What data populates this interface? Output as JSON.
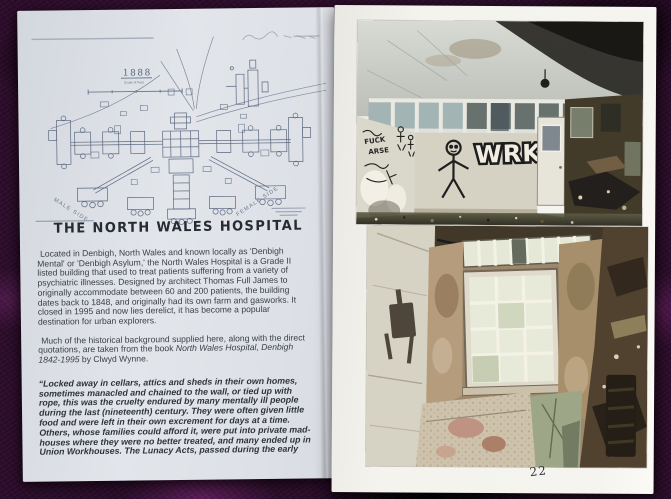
{
  "left_page": {
    "plan": {
      "year_label": "1888",
      "scale_label": "Scale of Feet",
      "male_side_label": "MALE SIDE",
      "female_side_label": "FEMALE SIDE"
    },
    "title": "THE NORTH WALES HOSPITAL",
    "intro_paragraph": "Located in Denbigh, North Wales and known locally as 'Denbigh Mental' or 'Denbigh Asylum,' the North Wales Hospital is a Grade II listed building that used to treat patients suffering from a variety of psychiatric illnesses. Designed by architect Thomas Full James to originally accommodate between 60 and 200 patients, the building dates back to 1848, and originally had its own farm and gasworks. It closed in 1995 and now lies derelict, it has become a popular destination for urban explorers.",
    "source_paragraph": {
      "prefix": "Much of the historical background supplied here, along with the direct quotations, are taken from the book ",
      "book_title": "North Wales Hospital, Denbigh 1842-1995",
      "suffix": " by Clwyd Wynne."
    },
    "quote_paragraph": "“Locked away in cellars, attics and sheds in their own homes, sometimes manacled and chained to the wall, or tied up with rope, this was the cruelty endured by many mentally ill people during the last (nineteenth) century. They were often given little food and were left in their own excrement for days at a time. Others, whose families could afford it, were put into private mad-houses where they were no better treated, and many ended up in Union Workhouses. The Lunacy Acts, passed during the early"
  },
  "right_page": {
    "page_number": "22",
    "top_photo": {
      "graffiti_tag": "WRKN",
      "graffiti_word_1": "FUCK",
      "graffiti_word_2": "ARSE"
    }
  },
  "colors": {
    "carpet_purple": "#2d0d2b",
    "left_page_paper": "#dde1e7",
    "right_page_paper": "#f4f3ee",
    "plan_ink": "#5a6880"
  }
}
